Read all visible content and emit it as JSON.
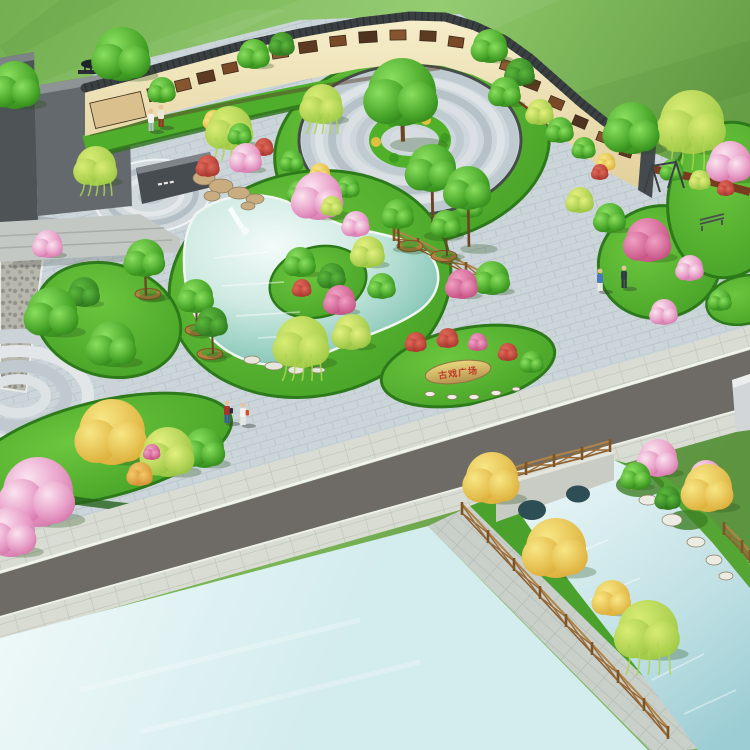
{
  "stone": {
    "text": "古戏广场",
    "text_color": "#c0392b"
  },
  "palette": {
    "field_green": "#74af52",
    "lawn_green": "#55b231",
    "dark_lawn_rim": "#2d7a1b",
    "plaza_paving": "#ccd6da",
    "sidewalk": "#d8dcd2",
    "road_asphalt": "#6e6b66",
    "open_water_cyan": "#ddf2f2",
    "pond_teal": "#8ecbbc",
    "canal_blue": "#bfe0e4",
    "wall_cream": "#f4ecca",
    "wall_coping_dark": "#3a3f42",
    "mural_sepia": "#7a4a28",
    "mulch_brown": "#7a3c1e",
    "wood_fence": "#9a6b34",
    "planter_pot": "#b5803f",
    "monument_gray": "#64696d",
    "bridge_stone": "#c8ccc4",
    "tree_green": "#46a428",
    "tree_dark_green": "#27701b",
    "tree_willow": "#97c33f",
    "tree_pink": "#e79cc6",
    "tree_magenta": "#c04578",
    "tree_yellow": "#d9a830",
    "tree_orange": "#cf8a2c",
    "tree_red": "#a03028",
    "stone_tan": "#cdb068"
  },
  "scene": {
    "streaks": [
      {
        "pts": "0,96 240,10 285,10 25,130",
        "fill": "#ffffff",
        "op": 0.06
      },
      {
        "pts": "300,0 560,0 420,62 185,42",
        "fill": "#ffffff",
        "op": 0.06
      },
      {
        "pts": "480,122 750,40 750,92 560,152",
        "fill": "#1e4f12",
        "op": 0.07
      },
      {
        "pts": "60,0 120,0 10,60 0,46",
        "fill": "#1e4f12",
        "op": 0.06
      }
    ],
    "murals": [
      {
        "x": 118,
        "y": 110,
        "w": 52,
        "h": 26,
        "r": -13,
        "c": "#d9c08d"
      },
      {
        "x": 158,
        "y": 93,
        "w": 20,
        "h": 13,
        "r": -14,
        "c": "#6b3f22"
      },
      {
        "x": 183,
        "y": 85,
        "w": 15,
        "h": 11,
        "r": -14,
        "c": "#875430"
      },
      {
        "x": 206,
        "y": 77,
        "w": 17,
        "h": 11,
        "r": -13,
        "c": "#5d3a22"
      },
      {
        "x": 230,
        "y": 68,
        "w": 15,
        "h": 10,
        "r": -12,
        "c": "#7a4a28"
      },
      {
        "x": 254,
        "y": 60,
        "w": 17,
        "h": 11,
        "r": -11,
        "c": "#4e3320"
      },
      {
        "x": 280,
        "y": 53,
        "w": 16,
        "h": 10,
        "r": -9,
        "c": "#8a5a32"
      },
      {
        "x": 308,
        "y": 47,
        "w": 18,
        "h": 11,
        "r": -8,
        "c": "#5d3a22"
      },
      {
        "x": 338,
        "y": 41,
        "w": 16,
        "h": 10,
        "r": -6,
        "c": "#7a4a28"
      },
      {
        "x": 368,
        "y": 37,
        "w": 18,
        "h": 11,
        "r": -4,
        "c": "#4e3320"
      },
      {
        "x": 398,
        "y": 35,
        "w": 16,
        "h": 10,
        "r": -1,
        "c": "#875430"
      },
      {
        "x": 428,
        "y": 36,
        "w": 16,
        "h": 10,
        "r": 3,
        "c": "#5d3a22"
      },
      {
        "x": 456,
        "y": 42,
        "w": 15,
        "h": 10,
        "r": 8,
        "c": "#7a4a28"
      },
      {
        "x": 482,
        "y": 52,
        "w": 15,
        "h": 10,
        "r": 13,
        "c": "#4e3320"
      },
      {
        "x": 508,
        "y": 66,
        "w": 15,
        "h": 10,
        "r": 17,
        "c": "#8a5a32"
      },
      {
        "x": 532,
        "y": 84,
        "w": 15,
        "h": 10,
        "r": 21,
        "c": "#5d3a22"
      },
      {
        "x": 556,
        "y": 103,
        "w": 15,
        "h": 10,
        "r": 23,
        "c": "#7a4a28"
      },
      {
        "x": 580,
        "y": 122,
        "w": 14,
        "h": 10,
        "r": 23,
        "c": "#4e3320"
      },
      {
        "x": 604,
        "y": 138,
        "w": 14,
        "h": 9,
        "r": 21,
        "c": "#875430"
      },
      {
        "x": 626,
        "y": 152,
        "w": 12,
        "h": 9,
        "r": 18,
        "c": "#5d3a22"
      }
    ],
    "fences": [
      {
        "name": "bridge-rail",
        "pts": [
          [
            498,
            482
          ],
          [
            526,
            474
          ],
          [
            554,
            466
          ],
          [
            582,
            459
          ],
          [
            610,
            451
          ]
        ]
      },
      {
        "name": "canal-left",
        "pts": [
          [
            462,
            514
          ],
          [
            488,
            542
          ],
          [
            514,
            570
          ],
          [
            540,
            598
          ],
          [
            566,
            626
          ],
          [
            592,
            654
          ],
          [
            618,
            682
          ],
          [
            644,
            710
          ],
          [
            668,
            738
          ]
        ]
      },
      {
        "name": "canal-right",
        "pts": [
          [
            724,
            534
          ],
          [
            742,
            552
          ],
          [
            750,
            562
          ]
        ]
      },
      {
        "name": "pond-side",
        "pts": [
          [
            394,
            240
          ],
          [
            418,
            250
          ],
          [
            442,
            262
          ],
          [
            466,
            274
          ],
          [
            490,
            286
          ]
        ]
      }
    ],
    "planters": [
      {
        "x": 148,
        "y": 294
      },
      {
        "x": 198,
        "y": 330
      },
      {
        "x": 210,
        "y": 354
      },
      {
        "x": 410,
        "y": 246
      },
      {
        "x": 444,
        "y": 256
      }
    ],
    "rocks": {
      "rockery": [
        [
          204,
          178,
          11,
          7
        ],
        [
          221,
          186,
          12,
          7
        ],
        [
          239,
          193,
          11,
          6
        ],
        [
          255,
          199,
          9,
          5
        ],
        [
          212,
          196,
          8,
          5
        ],
        [
          248,
          206,
          7,
          4
        ]
      ],
      "pond": [
        [
          252,
          360,
          8,
          4
        ],
        [
          274,
          366,
          9,
          4
        ],
        [
          296,
          370,
          8,
          4
        ],
        [
          318,
          370,
          7,
          3
        ]
      ],
      "canal": [
        [
          648,
          500,
          9,
          5
        ],
        [
          672,
          520,
          10,
          6
        ],
        [
          696,
          542,
          9,
          5
        ],
        [
          714,
          560,
          8,
          5
        ],
        [
          634,
          486,
          7,
          4
        ],
        [
          726,
          576,
          7,
          4
        ]
      ],
      "stonebed": [
        [
          430,
          394,
          5,
          2.5
        ],
        [
          452,
          397,
          5,
          2.5
        ],
        [
          474,
          397,
          5,
          2.5
        ],
        [
          496,
          393,
          5,
          2.5
        ],
        [
          516,
          389,
          4,
          2
        ]
      ]
    },
    "ripples": {
      "pond": [
        [
          214,
          258,
          268,
          252
        ],
        [
          222,
          286,
          284,
          282
        ],
        [
          236,
          316,
          300,
          312
        ],
        [
          258,
          338,
          322,
          334
        ]
      ],
      "canal": [
        [
          560,
          560,
          608,
          540
        ],
        [
          590,
          600,
          640,
          578
        ],
        [
          620,
          640,
          672,
          616
        ],
        [
          652,
          680,
          704,
          654
        ],
        [
          684,
          714,
          736,
          690
        ]
      ],
      "open": [
        [
          80,
          690,
          360,
          620
        ],
        [
          140,
          732,
          420,
          662
        ]
      ]
    },
    "trees": [
      {
        "t": "g",
        "x": 15,
        "y": 85,
        "r": 24
      },
      {
        "t": "g",
        "x": 122,
        "y": 54,
        "r": 27
      },
      {
        "t": "g",
        "x": 162,
        "y": 90,
        "r": 13
      },
      {
        "t": "w",
        "x": 96,
        "y": 166,
        "r": 20
      },
      {
        "t": "g",
        "x": 254,
        "y": 54,
        "r": 15
      },
      {
        "t": "d",
        "x": 282,
        "y": 44,
        "r": 12
      },
      {
        "t": "g",
        "x": 490,
        "y": 46,
        "r": 17
      },
      {
        "t": "d",
        "x": 520,
        "y": 72,
        "r": 14
      },
      {
        "t": "w",
        "x": 230,
        "y": 128,
        "r": 22
      },
      {
        "t": "y",
        "x": 214,
        "y": 120,
        "r": 10
      },
      {
        "t": "g",
        "x": 240,
        "y": 134,
        "r": 11
      },
      {
        "t": "r",
        "x": 264,
        "y": 147,
        "r": 9
      },
      {
        "t": "g",
        "x": 292,
        "y": 161,
        "r": 11
      },
      {
        "t": "y",
        "x": 320,
        "y": 173,
        "r": 10
      },
      {
        "t": "g",
        "x": 348,
        "y": 187,
        "r": 11
      },
      {
        "t": "w",
        "x": 322,
        "y": 104,
        "r": 20
      },
      {
        "t": "g",
        "x": 402,
        "y": 92,
        "r": 34,
        "k": 36
      },
      {
        "t": "g",
        "x": 505,
        "y": 92,
        "r": 15
      },
      {
        "t": "yg",
        "x": 540,
        "y": 112,
        "r": 13
      },
      {
        "t": "g",
        "x": 300,
        "y": 192,
        "r": 12
      },
      {
        "t": "yg",
        "x": 332,
        "y": 206,
        "r": 10
      },
      {
        "t": "g",
        "x": 470,
        "y": 206,
        "r": 12
      },
      {
        "t": "r",
        "x": 208,
        "y": 166,
        "r": 11
      },
      {
        "t": "p",
        "x": 246,
        "y": 158,
        "r": 15
      },
      {
        "t": "p",
        "x": 318,
        "y": 196,
        "r": 24
      },
      {
        "t": "p",
        "x": 356,
        "y": 224,
        "r": 13
      },
      {
        "t": "g",
        "x": 300,
        "y": 262,
        "r": 15
      },
      {
        "t": "d",
        "x": 332,
        "y": 276,
        "r": 13
      },
      {
        "t": "m",
        "x": 340,
        "y": 300,
        "r": 15
      },
      {
        "t": "r",
        "x": 302,
        "y": 288,
        "r": 9
      },
      {
        "t": "yg",
        "x": 368,
        "y": 252,
        "r": 16
      },
      {
        "t": "g",
        "x": 382,
        "y": 286,
        "r": 13
      },
      {
        "t": "g",
        "x": 432,
        "y": 168,
        "r": 24,
        "k": 56
      },
      {
        "t": "g",
        "x": 468,
        "y": 188,
        "r": 22,
        "k": 50
      },
      {
        "t": "g",
        "x": 398,
        "y": 214,
        "r": 15,
        "k": 28
      },
      {
        "t": "g",
        "x": 446,
        "y": 224,
        "r": 14,
        "k": 26
      },
      {
        "t": "w",
        "x": 302,
        "y": 342,
        "r": 26
      },
      {
        "t": "yg",
        "x": 352,
        "y": 332,
        "r": 18
      },
      {
        "t": "g",
        "x": 492,
        "y": 278,
        "r": 17
      },
      {
        "t": "m",
        "x": 462,
        "y": 284,
        "r": 15
      },
      {
        "t": "g",
        "x": 145,
        "y": 258,
        "r": 19,
        "k": 30
      },
      {
        "t": "g",
        "x": 196,
        "y": 296,
        "r": 17,
        "k": 28
      },
      {
        "t": "d",
        "x": 212,
        "y": 322,
        "r": 15,
        "k": 26
      },
      {
        "t": "p",
        "x": 48,
        "y": 244,
        "r": 14
      },
      {
        "t": "g",
        "x": 52,
        "y": 312,
        "r": 25
      },
      {
        "t": "g",
        "x": 112,
        "y": 344,
        "r": 23
      },
      {
        "t": "d",
        "x": 84,
        "y": 292,
        "r": 15
      },
      {
        "t": "y",
        "x": 112,
        "y": 432,
        "r": 33
      },
      {
        "t": "yg",
        "x": 168,
        "y": 452,
        "r": 25
      },
      {
        "t": "g",
        "x": 204,
        "y": 448,
        "r": 20
      },
      {
        "t": "p",
        "x": 38,
        "y": 492,
        "r": 35
      },
      {
        "t": "p",
        "x": 10,
        "y": 532,
        "r": 25
      },
      {
        "t": "o",
        "x": 140,
        "y": 474,
        "r": 12
      },
      {
        "t": "m",
        "x": 152,
        "y": 452,
        "r": 8
      },
      {
        "t": "r",
        "x": 416,
        "y": 342,
        "r": 10
      },
      {
        "t": "r",
        "x": 448,
        "y": 338,
        "r": 10
      },
      {
        "t": "m",
        "x": 478,
        "y": 342,
        "r": 9
      },
      {
        "t": "r",
        "x": 508,
        "y": 352,
        "r": 9
      },
      {
        "t": "g",
        "x": 532,
        "y": 362,
        "r": 11
      },
      {
        "t": "g",
        "x": 610,
        "y": 218,
        "r": 15
      },
      {
        "t": "yg",
        "x": 580,
        "y": 200,
        "r": 13
      },
      {
        "t": "m",
        "x": 648,
        "y": 240,
        "r": 22
      },
      {
        "t": "p",
        "x": 690,
        "y": 268,
        "r": 13
      },
      {
        "t": "w",
        "x": 692,
        "y": 122,
        "r": 32
      },
      {
        "t": "g",
        "x": 632,
        "y": 128,
        "r": 26
      },
      {
        "t": "p",
        "x": 730,
        "y": 162,
        "r": 21
      },
      {
        "t": "p",
        "x": 664,
        "y": 312,
        "r": 13
      },
      {
        "t": "g",
        "x": 720,
        "y": 300,
        "r": 11
      },
      {
        "t": "g",
        "x": 560,
        "y": 130,
        "r": 13
      },
      {
        "t": "g",
        "x": 584,
        "y": 148,
        "r": 11
      },
      {
        "t": "y",
        "x": 606,
        "y": 162,
        "r": 9
      },
      {
        "t": "r",
        "x": 600,
        "y": 172,
        "r": 8
      },
      {
        "t": "g",
        "x": 672,
        "y": 170,
        "r": 11
      },
      {
        "t": "yg",
        "x": 700,
        "y": 180,
        "r": 10
      },
      {
        "t": "r",
        "x": 726,
        "y": 188,
        "r": 8
      },
      {
        "t": "y",
        "x": 492,
        "y": 478,
        "r": 26
      },
      {
        "t": "y",
        "x": 556,
        "y": 548,
        "r": 30
      },
      {
        "t": "y",
        "x": 612,
        "y": 598,
        "r": 18
      },
      {
        "t": "w",
        "x": 648,
        "y": 630,
        "r": 30
      },
      {
        "t": "p",
        "x": 658,
        "y": 458,
        "r": 19
      },
      {
        "t": "p",
        "x": 706,
        "y": 476,
        "r": 16
      },
      {
        "t": "y",
        "x": 708,
        "y": 488,
        "r": 24
      },
      {
        "t": "g",
        "x": 636,
        "y": 476,
        "r": 14
      },
      {
        "t": "d",
        "x": 668,
        "y": 498,
        "r": 12
      }
    ],
    "people": [
      {
        "x": 151,
        "y": 116,
        "top": "#f2f2f0",
        "pants": "#b8bcc4"
      },
      {
        "x": 161,
        "y": 112,
        "top": "#ece4d4",
        "pants": "#9c2c24"
      },
      {
        "x": 227,
        "y": 408,
        "top": "#a83430",
        "pants": "#3a5aa0",
        "bag": "#262c34"
      },
      {
        "x": 243,
        "y": 410,
        "top": "#f2f0ec",
        "pants": "#eceae4",
        "bag": "#d84a22"
      },
      {
        "x": 600,
        "y": 276,
        "top": "#4878c0",
        "pants": "#eeeee8"
      },
      {
        "x": 624,
        "y": 273,
        "top": "#343c4c",
        "pants": "#2c3440"
      }
    ]
  }
}
